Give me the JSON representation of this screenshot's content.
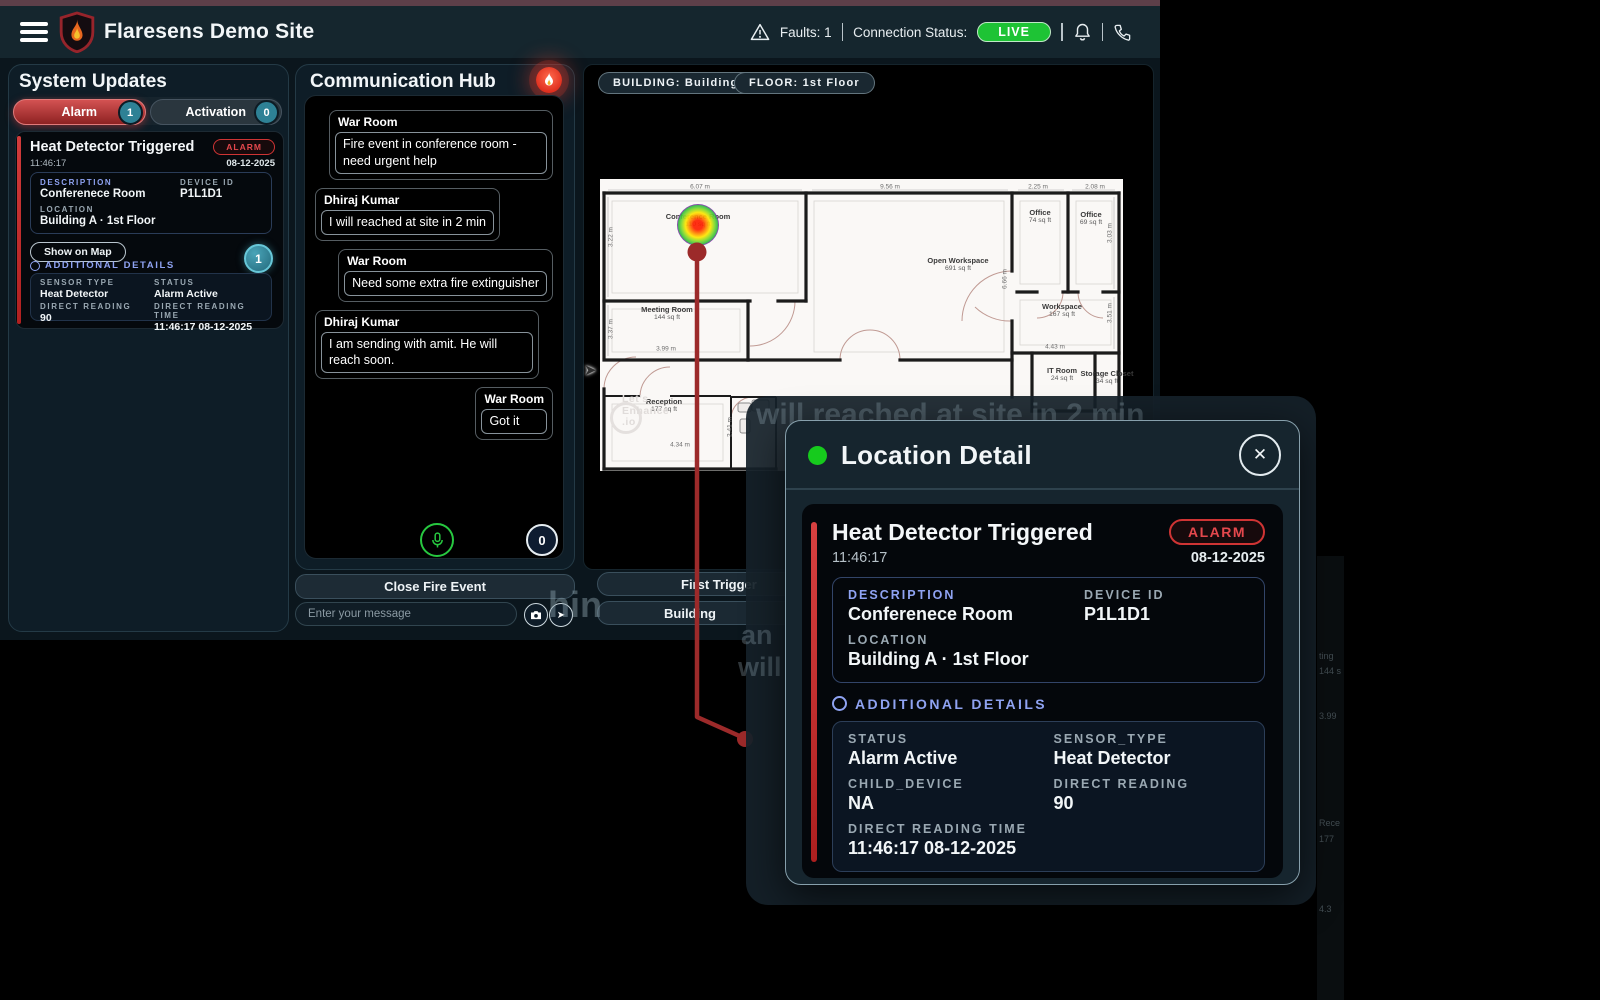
{
  "header": {
    "title": "Flaresens Demo Site",
    "faults_label": "Faults: 1",
    "connection_label": "Connection Status:",
    "live_badge": "LIVE"
  },
  "system_updates": {
    "title": "System Updates",
    "tabs": [
      {
        "label": "Alarm",
        "badge": "1"
      },
      {
        "label": "Activation",
        "badge": "0"
      }
    ],
    "alarm_card": {
      "title": "Heat Detector Triggered",
      "badge": "ALARM",
      "time": "11:46:17",
      "date": "08-12-2025",
      "description_label": "DESCRIPTION",
      "description": "Conferenece Room",
      "device_id_label": "DEVICE ID",
      "device_id": "P1L1D1",
      "location_label": "LOCATION",
      "location": "Building A · 1st Floor",
      "show_on_map": "Show on Map",
      "count_badge": "1",
      "additional_details_label": "ADDITIONAL DETAILS",
      "fields": [
        {
          "label": "SENSOR TYPE",
          "value": "Heat Detector"
        },
        {
          "label": "STATUS",
          "value": "Alarm Active"
        },
        {
          "label": "DIRECT READING",
          "value": "90"
        },
        {
          "label": "DIRECT READING TIME",
          "value": "11:46:17 08-12-2025"
        }
      ]
    }
  },
  "communication_hub": {
    "title": "Communication Hub",
    "messages": [
      {
        "sender": "War Room",
        "text": "Fire event in conference room - need urgent help",
        "side": "right"
      },
      {
        "sender": "Dhiraj Kumar",
        "text": "I will reached at site in 2 min",
        "side": "left"
      },
      {
        "sender": "War Room",
        "text": "Need some extra fire extinguisher",
        "side": "right"
      },
      {
        "sender": "Dhiraj Kumar",
        "text": "I am sending with amit. He will reach soon.",
        "side": "left"
      },
      {
        "sender": "War Room",
        "text": "Got it",
        "side": "right"
      }
    ],
    "recording_count": "0",
    "close_button": "Close Fire Event",
    "input_placeholder": "Enter your message"
  },
  "map": {
    "building_chip": "BUILDING: Building A",
    "floor_chip": "FLOOR: 1st Floor",
    "first_trigger_button": "First Trigger",
    "building_button": "Building",
    "watermark_lines": [
      "Let's",
      "Enhance",
      ".io"
    ],
    "rooms": [
      {
        "name": "Conference Room",
        "area": "110 sq ft",
        "x": 98,
        "y": 42
      },
      {
        "name": "Meeting Room",
        "area": "144 sq ft",
        "x": 67,
        "y": 135
      },
      {
        "name": "Open Workspace",
        "area": "691 sq ft",
        "x": 358,
        "y": 86
      },
      {
        "name": "Office",
        "area": "74 sq ft",
        "x": 440,
        "y": 38
      },
      {
        "name": "Office",
        "area": "69 sq ft",
        "x": 491,
        "y": 40
      },
      {
        "name": "Workspace",
        "area": "167 sq ft",
        "x": 462,
        "y": 132
      },
      {
        "name": "IT Room",
        "area": "24 sq ft",
        "x": 462,
        "y": 196
      },
      {
        "name": "Storage Closet",
        "area": "34 sq ft",
        "x": 507,
        "y": 199
      },
      {
        "name": "Reception",
        "area": "177 sq ft",
        "x": 64,
        "y": 227
      }
    ],
    "dimensions": [
      {
        "t": "6.07 m",
        "x": 100,
        "y": 8
      },
      {
        "t": "9.56 m",
        "x": 290,
        "y": 8
      },
      {
        "t": "2.25 m",
        "x": 438,
        "y": 8
      },
      {
        "t": "2.08 m",
        "x": 495,
        "y": 8
      },
      {
        "t": "3.22 m",
        "x": 11,
        "y": 58,
        "v": true
      },
      {
        "t": "3.37 m",
        "x": 11,
        "y": 150,
        "v": true
      },
      {
        "t": "3.99 m",
        "x": 66,
        "y": 170
      },
      {
        "t": "6.66 m",
        "x": 405,
        "y": 100,
        "v": true
      },
      {
        "t": "3.03 m",
        "x": 510,
        "y": 54,
        "v": true
      },
      {
        "t": "3.51 m",
        "x": 510,
        "y": 134,
        "v": true
      },
      {
        "t": "4.43 m",
        "x": 455,
        "y": 168
      },
      {
        "t": "2.41 m",
        "x": 130,
        "y": 248,
        "v": true
      },
      {
        "t": "4.34 m",
        "x": 80,
        "y": 266
      }
    ]
  },
  "location_detail": {
    "title": "Location Detail",
    "card": {
      "title": "Heat Detector Triggered",
      "badge": "ALARM",
      "time": "11:46:17",
      "date": "08-12-2025",
      "description_label": "DESCRIPTION",
      "description": "Conferenece Room",
      "device_id_label": "DEVICE ID",
      "device_id": "P1L1D1",
      "location_label": "LOCATION",
      "location": "Building A · 1st Floor",
      "additional_details_label": "ADDITIONAL DETAILS",
      "fields": [
        {
          "label": "STATUS",
          "value": "Alarm Active"
        },
        {
          "label": "SENSOR_TYPE",
          "value": "Heat Detector"
        },
        {
          "label": "CHILD_DEVICE",
          "value": "NA"
        },
        {
          "label": "DIRECT READING",
          "value": "90"
        },
        {
          "label": "DIRECT READING TIME",
          "value": "11:46:17 08-12-2025",
          "span": 2
        }
      ]
    }
  },
  "ghost": {
    "g1": "will reached at site in 2 min",
    "g2": "hin",
    "g3": "an",
    "g4": "will",
    "strip": [
      {
        "t": "ting",
        "y": 95
      },
      {
        "t": "144 s",
        "y": 110
      },
      {
        "t": "3.99",
        "y": 155
      },
      {
        "t": "Rece",
        "y": 262
      },
      {
        "t": "177",
        "y": 278
      },
      {
        "t": "4.3",
        "y": 348
      }
    ]
  }
}
